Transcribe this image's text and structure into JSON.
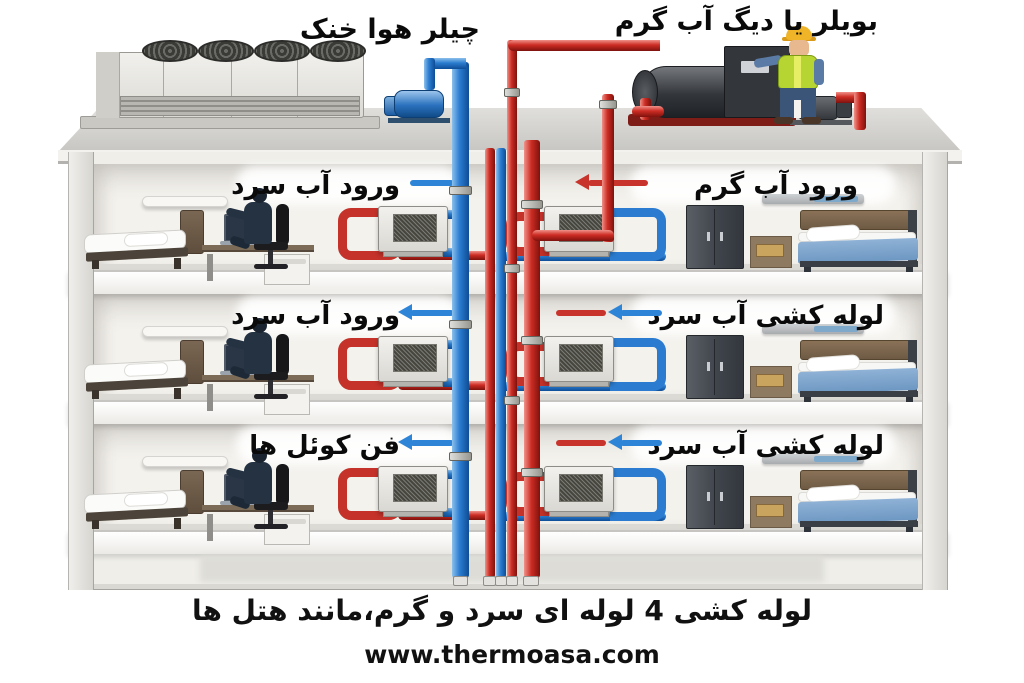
{
  "titles": {
    "chiller": "چیلر هوا خنک",
    "boiler": "بویلر یا دیگ آب گرم"
  },
  "floors": [
    {
      "left_label": "ورود آب سرد",
      "right_label": "ورود آب گرم"
    },
    {
      "left_label": "ورود آب سرد",
      "right_label": "لوله کشی آب سرد"
    },
    {
      "left_label": "فن کوئل ها",
      "right_label": "لوله کشی آب سرد"
    }
  ],
  "caption": "لوله کشی 4 لوله ای سرد و گرم،مانند هتل ها",
  "website": "www.thermoasa.com",
  "colors": {
    "cold_water": "#2b7cd0",
    "hot_water": "#c8342c"
  }
}
